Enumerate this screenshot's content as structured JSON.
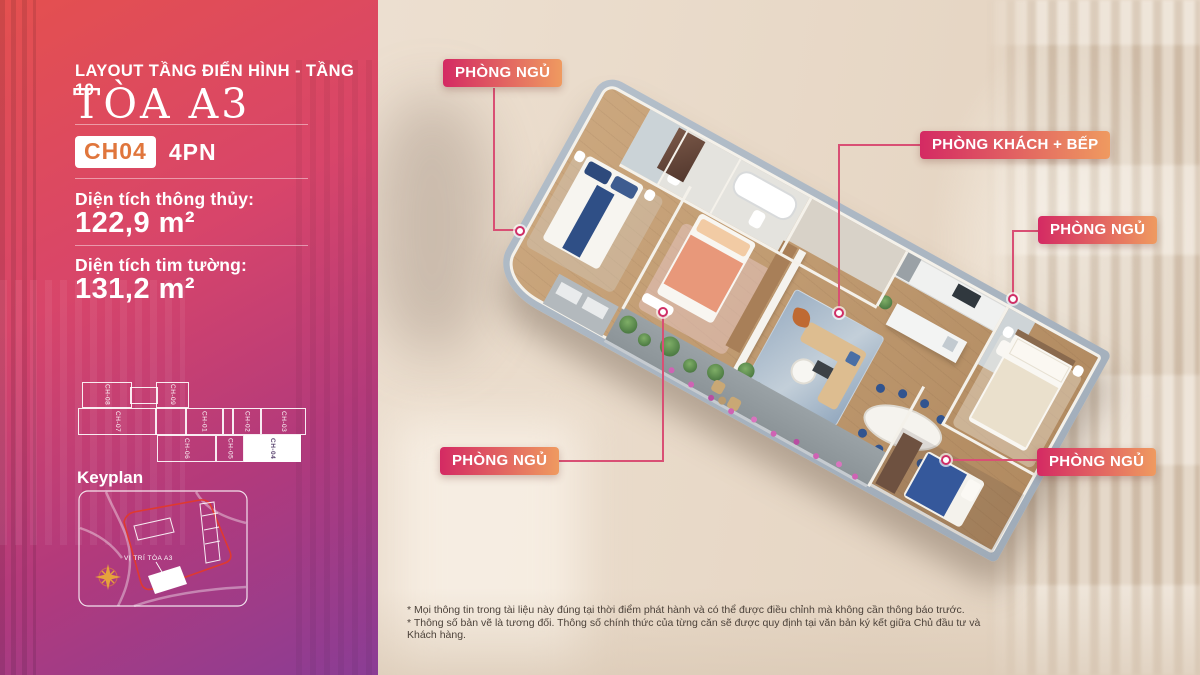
{
  "panel": {
    "subtitle": "LAYOUT TẦNG ĐIỂN HÌNH - TẦNG 19",
    "title": "TÒA A3",
    "unit": {
      "code": "CH04",
      "type": "4PN"
    },
    "areas": [
      {
        "label": "Diện tích thông thủy:",
        "value": "122,9 m²"
      },
      {
        "label": "Diện tích tim tường:",
        "value": "131,2 m²"
      }
    ],
    "keyplan": {
      "title": "Keyplan",
      "marker_label": "VỊ TRÍ TÒA A3"
    },
    "floor_strip": {
      "units": [
        {
          "id": "CH-08",
          "highlighted": false
        },
        {
          "id": "CH-09",
          "highlighted": false
        },
        {
          "id": "CH-07",
          "highlighted": false
        },
        {
          "id": "CH-01",
          "highlighted": false
        },
        {
          "id": "CH-02",
          "highlighted": false
        },
        {
          "id": "CH-03",
          "highlighted": false
        },
        {
          "id": "CH-06",
          "highlighted": false
        },
        {
          "id": "CH-05",
          "highlighted": false
        },
        {
          "id": "CH-04",
          "highlighted": true
        }
      ]
    }
  },
  "plan": {
    "labels": [
      {
        "id": "bedroom-top-left",
        "text": "PHÒNG NGỦ"
      },
      {
        "id": "living-kitchen",
        "text": "PHÒNG KHÁCH + BẾP"
      },
      {
        "id": "bedroom-right",
        "text": "PHÒNG NGỦ"
      },
      {
        "id": "bedroom-bottom-left",
        "text": "PHÒNG NGỦ"
      },
      {
        "id": "bedroom-bottom-right",
        "text": "PHÒNG NGỦ"
      }
    ]
  },
  "footnotes": [
    "* Mọi thông tin trong tài liệu này đúng tại thời điểm phát hành và có thể được điều chỉnh mà không cần thông báo trước.",
    "* Thông số bản vẽ là tương đối. Thông số chính thức của từng căn sẽ được quy định tại văn bản ký kết giữa Chủ đầu tư và Khách hàng."
  ],
  "colors": {
    "panel_gradient_start": "#e4504f",
    "panel_gradient_end": "#8a3d95",
    "label_gradient_start": "#d42a63",
    "label_gradient_end": "#ef9a60",
    "badge_text": "#e0763c",
    "leader_line": "#d94f74",
    "wall": "#a8b4c0",
    "wood_floor": "#c0996e"
  }
}
